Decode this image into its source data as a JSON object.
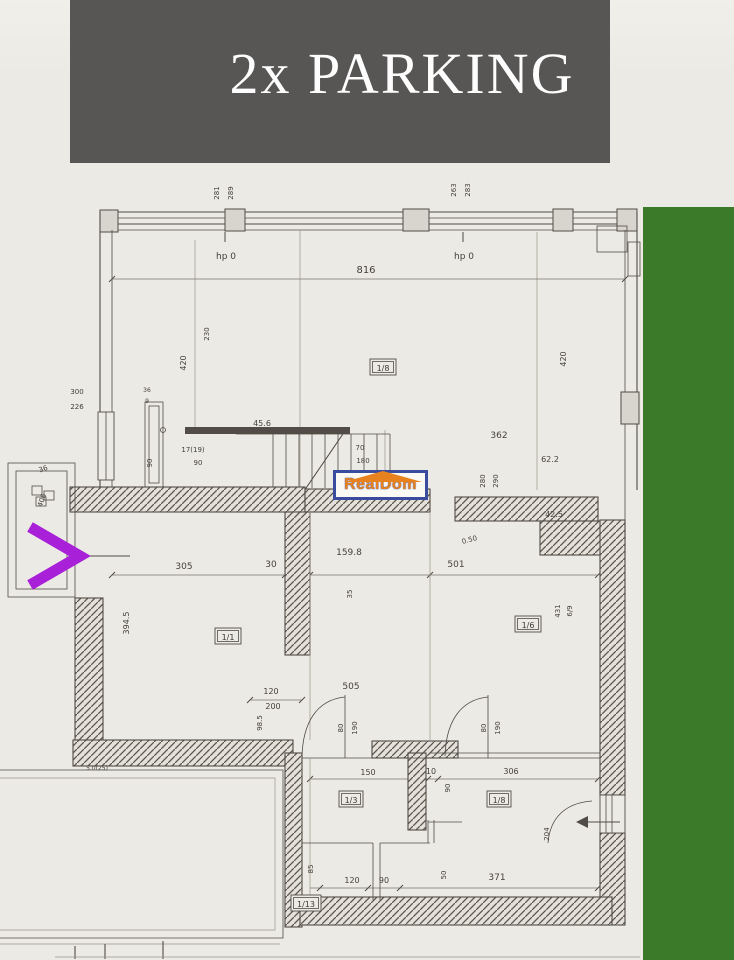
{
  "banner": {
    "title": "2x PARKING"
  },
  "watermark": {
    "text": "RealDom"
  },
  "annotation": {
    "shape": "right-chevron"
  },
  "colors": {
    "banner_bg": "#585555",
    "banner_fg": "#fdfdfd",
    "paper": "#eceae4",
    "ink": "#514c45",
    "green": "#3a7a28",
    "purple": "#a820d8",
    "logo_orange": "#e8821e",
    "logo_navy": "#3a4c9e"
  },
  "plan": {
    "dim_labels": [
      {
        "t": "281",
        "x": 219,
        "y": 193,
        "r": -90,
        "s": 7
      },
      {
        "t": "289",
        "x": 233,
        "y": 193,
        "r": -90,
        "s": 7
      },
      {
        "t": "263",
        "x": 456,
        "y": 190,
        "r": -90,
        "s": 7
      },
      {
        "t": "283",
        "x": 470,
        "y": 190,
        "r": -90,
        "s": 7
      },
      {
        "t": "hp 0",
        "x": 226,
        "y": 259,
        "s": 9
      },
      {
        "t": "hp 0",
        "x": 464,
        "y": 259,
        "s": 9
      },
      {
        "t": "816",
        "x": 366,
        "y": 273,
        "s": 10
      },
      {
        "t": "230",
        "x": 209,
        "y": 334,
        "r": -90,
        "s": 7
      },
      {
        "t": "420",
        "x": 186,
        "y": 363,
        "r": -90,
        "s": 8
      },
      {
        "t": "420",
        "x": 566,
        "y": 359,
        "r": -90,
        "s": 8
      },
      {
        "t": "362",
        "x": 499,
        "y": 438,
        "s": 9
      },
      {
        "t": "300",
        "x": 77,
        "y": 394,
        "s": 7
      },
      {
        "t": "226",
        "x": 77,
        "y": 409,
        "s": 7
      },
      {
        "t": "36",
        "x": 147,
        "y": 392,
        "s": 6
      },
      {
        "t": "9",
        "x": 147,
        "y": 403,
        "s": 6
      },
      {
        "t": "45.6",
        "x": 262,
        "y": 426,
        "s": 8
      },
      {
        "t": "90",
        "x": 152,
        "y": 463,
        "r": -90,
        "s": 7
      },
      {
        "t": "17(19)",
        "x": 193,
        "y": 452,
        "s": 7
      },
      {
        "t": "90",
        "x": 198,
        "y": 465,
        "s": 7
      },
      {
        "t": "70",
        "x": 360,
        "y": 450,
        "s": 7
      },
      {
        "t": "180",
        "x": 363,
        "y": 463,
        "s": 7
      },
      {
        "t": "62.2",
        "x": 550,
        "y": 462,
        "s": 8
      },
      {
        "t": "42.5",
        "x": 554,
        "y": 517,
        "s": 8
      },
      {
        "t": "280",
        "x": 485,
        "y": 481,
        "r": -90,
        "s": 7
      },
      {
        "t": "290",
        "x": 498,
        "y": 481,
        "r": -90,
        "s": 7
      },
      {
        "t": "36",
        "x": 44,
        "y": 471,
        "r": -20,
        "s": 7
      },
      {
        "t": "406",
        "x": 44,
        "y": 501,
        "r": -70,
        "s": 7
      },
      {
        "t": "305",
        "x": 184,
        "y": 569,
        "s": 9
      },
      {
        "t": "30",
        "x": 271,
        "y": 567,
        "s": 9
      },
      {
        "t": "159.8",
        "x": 349,
        "y": 555,
        "s": 9
      },
      {
        "t": "35",
        "x": 352,
        "y": 594,
        "r": -90,
        "s": 7
      },
      {
        "t": "0.50",
        "x": 470,
        "y": 542,
        "r": -15,
        "s": 7
      },
      {
        "t": "501",
        "x": 456,
        "y": 567,
        "s": 9
      },
      {
        "t": "394.5",
        "x": 129,
        "y": 623,
        "r": -90,
        "s": 8
      },
      {
        "t": "431",
        "x": 560,
        "y": 611,
        "r": -90,
        "s": 7
      },
      {
        "t": "6/9",
        "x": 572,
        "y": 611,
        "r": -90,
        "s": 7
      },
      {
        "t": "505",
        "x": 351,
        "y": 689,
        "s": 9
      },
      {
        "t": "120",
        "x": 271,
        "y": 694,
        "s": 8
      },
      {
        "t": "200",
        "x": 273,
        "y": 709,
        "s": 8
      },
      {
        "t": "98.5",
        "x": 262,
        "y": 723,
        "r": -90,
        "s": 7
      },
      {
        "t": "80",
        "x": 343,
        "y": 728,
        "r": -90,
        "s": 7
      },
      {
        "t": "190",
        "x": 357,
        "y": 728,
        "r": -90,
        "s": 7
      },
      {
        "t": "80",
        "x": 486,
        "y": 728,
        "r": -90,
        "s": 7
      },
      {
        "t": "190",
        "x": 500,
        "y": 728,
        "r": -90,
        "s": 7
      },
      {
        "t": "5.0(25)",
        "x": 97,
        "y": 770,
        "s": 6
      },
      {
        "t": "150",
        "x": 368,
        "y": 775,
        "s": 8
      },
      {
        "t": "10",
        "x": 431,
        "y": 774,
        "s": 8
      },
      {
        "t": "306",
        "x": 511,
        "y": 774,
        "s": 8
      },
      {
        "t": "90",
        "x": 450,
        "y": 788,
        "r": -90,
        "s": 7
      },
      {
        "t": "204",
        "x": 549,
        "y": 834,
        "r": -90,
        "s": 7
      },
      {
        "t": "85",
        "x": 313,
        "y": 869,
        "r": -90,
        "s": 7
      },
      {
        "t": "50",
        "x": 446,
        "y": 875,
        "r": -90,
        "s": 7
      },
      {
        "t": "120",
        "x": 352,
        "y": 883,
        "s": 8
      },
      {
        "t": "90",
        "x": 384,
        "y": 883,
        "s": 8
      },
      {
        "t": "371",
        "x": 497,
        "y": 880,
        "s": 9
      }
    ],
    "room_tags": [
      {
        "t": "1/8",
        "x": 383,
        "y": 371,
        "w": 26
      },
      {
        "t": "1/1",
        "x": 228,
        "y": 640,
        "w": 26
      },
      {
        "t": "1/6",
        "x": 528,
        "y": 628,
        "w": 26
      },
      {
        "t": "1/3",
        "x": 351,
        "y": 803,
        "w": 24
      },
      {
        "t": "1/8",
        "x": 499,
        "y": 803,
        "w": 24
      },
      {
        "t": "1/13",
        "x": 306,
        "y": 907,
        "w": 30
      }
    ]
  }
}
